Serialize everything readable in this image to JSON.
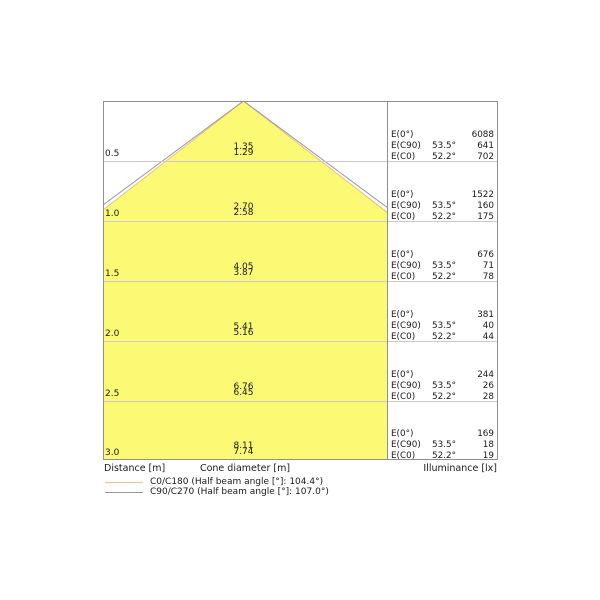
{
  "chart_data": {
    "type": "area",
    "subtype": "photometric-cone-diagram",
    "distances_m": [
      0.5,
      1.0,
      1.5,
      2.0,
      2.5,
      3.0
    ],
    "series": [
      {
        "name": "C0/C180",
        "half_beam_angle_deg": 104.4,
        "half_angle_deg": 52.2,
        "cone_diameters_m": [
          1.29,
          2.58,
          3.87,
          5.16,
          6.45,
          7.74
        ],
        "illuminance_lx": [
          702,
          175,
          78,
          44,
          28,
          19
        ],
        "line_color": "#ecbf86"
      },
      {
        "name": "C90/C270",
        "half_beam_angle_deg": 107.0,
        "half_angle_deg": 53.5,
        "cone_diameters_m": [
          1.35,
          2.7,
          4.05,
          5.41,
          6.76,
          8.11
        ],
        "illuminance_lx": [
          641,
          160,
          71,
          40,
          26,
          18
        ],
        "line_color": "#9a9a9a"
      }
    ],
    "center_beam_illuminance": {
      "label": "E(0°)",
      "values_lx": [
        6088,
        1522,
        676,
        381,
        244,
        169
      ]
    },
    "axes": {
      "left": "Distance [m]",
      "bottom": "Cone diameter [m]",
      "right": "Illuminance [lx]"
    },
    "grid": "horizontal-0.5m-steps",
    "legend_position": "bottom-left",
    "cone_fill_color": "#fcfa75"
  },
  "labels": {
    "e0": "E(0°)",
    "ec90": "E(C90)",
    "ec0": "E(C0)"
  },
  "rows": [
    {
      "distance": "0.5",
      "dia_c90": "1.35",
      "dia_c0": "1.29",
      "angle_c90": "53.5°",
      "angle_c0": "52.2°",
      "e0": "6088",
      "ec90": "641",
      "ec0": "702"
    },
    {
      "distance": "1.0",
      "dia_c90": "2.70",
      "dia_c0": "2.58",
      "angle_c90": "53.5°",
      "angle_c0": "52.2°",
      "e0": "1522",
      "ec90": "160",
      "ec0": "175"
    },
    {
      "distance": "1.5",
      "dia_c90": "4.05",
      "dia_c0": "3.87",
      "angle_c90": "53.5°",
      "angle_c0": "52.2°",
      "e0": "676",
      "ec90": "71",
      "ec0": "78"
    },
    {
      "distance": "2.0",
      "dia_c90": "5.41",
      "dia_c0": "5.16",
      "angle_c90": "53.5°",
      "angle_c0": "52.2°",
      "e0": "381",
      "ec90": "40",
      "ec0": "44"
    },
    {
      "distance": "2.5",
      "dia_c90": "6.76",
      "dia_c0": "6.45",
      "angle_c90": "53.5°",
      "angle_c0": "52.2°",
      "e0": "244",
      "ec90": "26",
      "ec0": "28"
    },
    {
      "distance": "3.0",
      "dia_c90": "8.11",
      "dia_c0": "7.74",
      "angle_c90": "53.5°",
      "angle_c0": "52.2°",
      "e0": "169",
      "ec90": "18",
      "ec0": "19"
    }
  ],
  "footer": {
    "distance_label": "Distance [m]",
    "cone_diameter_label": "Cone diameter [m]",
    "illuminance_label": "Illuminance [lx]"
  },
  "legend": {
    "c0": {
      "label": "C0/C180 (Half beam angle [°]: 104.4°)",
      "color": "#ecbf86"
    },
    "c90": {
      "label": "C90/C270 (Half beam angle [°]: 107.0°)",
      "color": "#9a9a9a"
    }
  },
  "colors": {
    "cone_fill": "#fcfa75",
    "c0_line": "#ecbf86",
    "c90_line": "#9a9a9a",
    "gridline": "#cbcbcb",
    "frame": "#8f8f8f",
    "background": "#ffffff"
  }
}
